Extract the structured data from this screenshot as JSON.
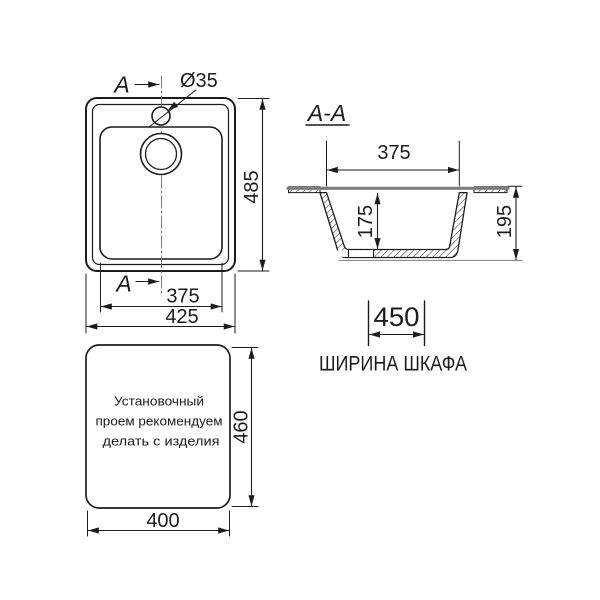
{
  "colors": {
    "line": "#1c1c1c",
    "countertop_gray": "#7e7e7e",
    "centerline_gray": "#6e6e6e",
    "background": "#ffffff"
  },
  "top_view": {
    "section_arrow_label_top": "A",
    "section_arrow_label_bottom": "A",
    "faucet_hole_diameter": "Ø35",
    "dim_height": "485",
    "dim_bowl_width": "375",
    "dim_overall_width": "425"
  },
  "section_view": {
    "title": "A-A",
    "dim_bowl_top_width": "375",
    "dim_bowl_depth": "175",
    "dim_overall_depth": "195"
  },
  "cabinet": {
    "dim_width": "450",
    "caption": "ШИРИНА ШКАФА"
  },
  "cutout_view": {
    "note_line_1": "Установочный",
    "note_line_2": "проем рекомендуем",
    "note_line_3": "делать с изделия",
    "dim_height": "460",
    "dim_width": "400"
  }
}
